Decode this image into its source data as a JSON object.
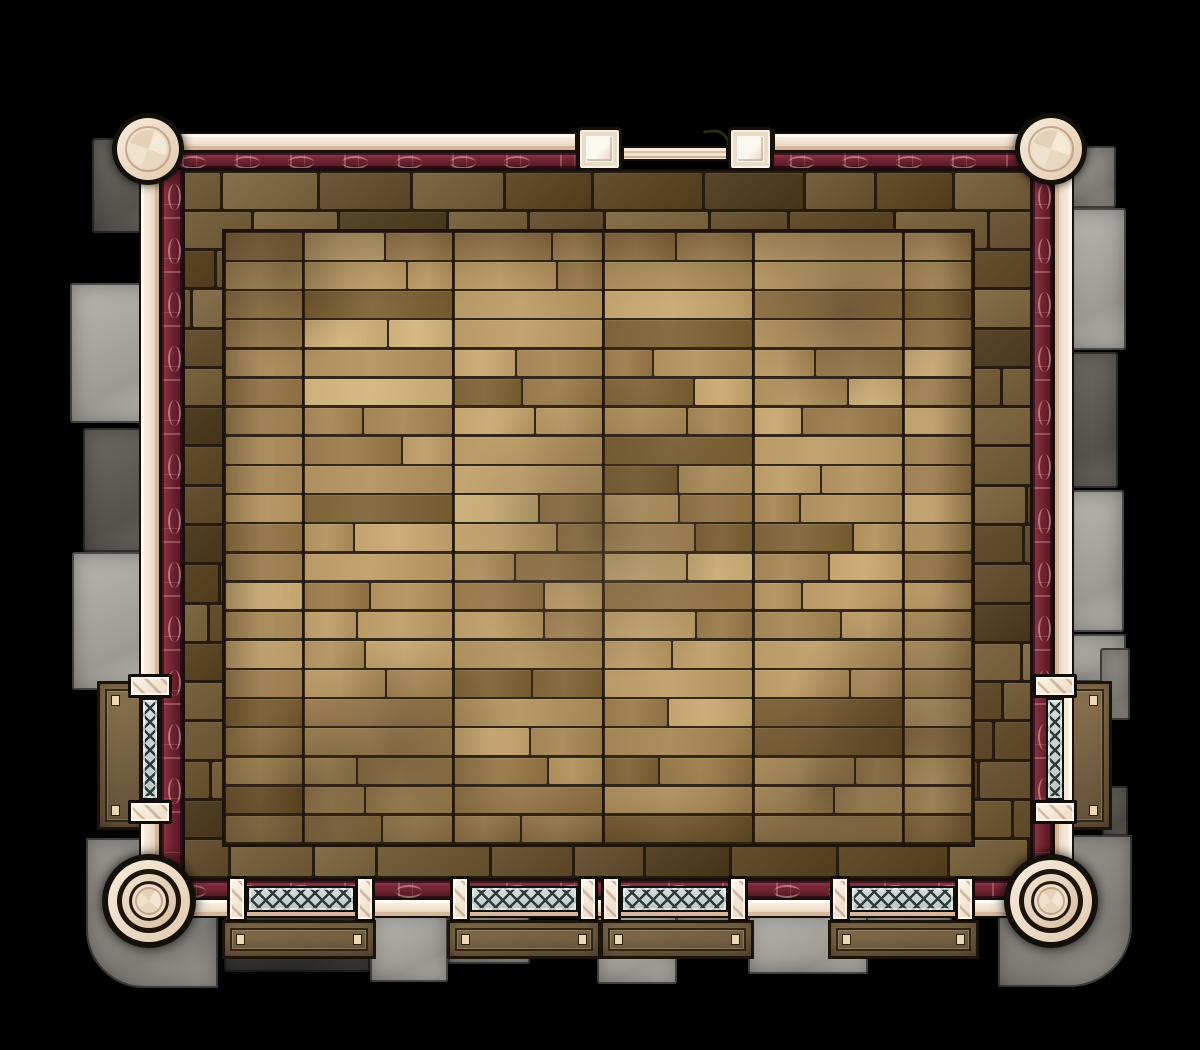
{
  "scene": {
    "kind": "battle-map",
    "label": "stone-hall-with-wood-floor-and-balconies",
    "canvas": {
      "w": 1200,
      "h": 1050,
      "bg": "#000000"
    }
  },
  "palette": {
    "stone": {
      "l": [
        "#b8b6b0",
        "#9d9a94"
      ],
      "m": [
        "#9b9892",
        "#807d77"
      ],
      "d": [
        "#6d6a64",
        "#55524d"
      ],
      "k": [
        "#403e3b",
        "#2f2e2c"
      ]
    },
    "brick": [
      "#6d5839",
      "#76613f",
      "#64502f",
      "#7d6845",
      "#59472b",
      "#85704b"
    ],
    "brick_gap": "#251b10",
    "wood_base": [
      "#c3a46f",
      "#b99a66",
      "#ae905e",
      "#a28455",
      "#97794b"
    ],
    "wood_dark": "#7e6338",
    "wood_light": "#ccb07a",
    "wood_gap": "#33261a",
    "wall_cream_hi": "#fbf4e8",
    "wall_cream_lo": "#e2c9af",
    "outline": "#17100a",
    "trim_red_hi": "#93394a",
    "trim_red_lo": "#521624",
    "trim_motif": "rgba(242,198,188,0.5)",
    "lattice_bg_hi": "#d6dedb",
    "lattice_bg_lo": "#bcc7c4",
    "lattice_line": "#2c3a3c",
    "platform_hi": "#8a7350",
    "platform_lo": "#63513a",
    "peg": "#ead8b6",
    "pillar_cream_hi": "#f7ecdb",
    "pillar_cream_lo": "#e2cab0"
  },
  "stones": [
    [
      92,
      138,
      66,
      95,
      "d",
      null
    ],
    [
      70,
      283,
      90,
      140,
      "l",
      null
    ],
    [
      83,
      428,
      76,
      124,
      "d",
      null
    ],
    [
      72,
      552,
      88,
      138,
      "l",
      null
    ],
    [
      86,
      838,
      132,
      150,
      "m",
      "0 0 0 58px"
    ],
    [
      1066,
      146,
      50,
      62,
      "m",
      null
    ],
    [
      1064,
      208,
      62,
      142,
      "l",
      null
    ],
    [
      1066,
      352,
      52,
      136,
      "d",
      null
    ],
    [
      1064,
      490,
      60,
      142,
      "l",
      null
    ],
    [
      1062,
      634,
      64,
      48,
      "l",
      null
    ],
    [
      1100,
      648,
      30,
      72,
      "m",
      null
    ],
    [
      1102,
      786,
      26,
      50,
      "d",
      null
    ],
    [
      998,
      835,
      134,
      152,
      "m",
      "0 0 62px 0"
    ],
    [
      224,
      912,
      146,
      60,
      "k",
      null
    ],
    [
      370,
      912,
      78,
      70,
      "l",
      null
    ],
    [
      448,
      912,
      82,
      52,
      "m",
      null
    ],
    [
      597,
      912,
      80,
      72,
      "l",
      null
    ],
    [
      676,
      912,
      74,
      46,
      "m",
      null
    ],
    [
      748,
      912,
      120,
      62,
      "l",
      null
    ],
    [
      866,
      912,
      86,
      42,
      "m",
      null
    ]
  ],
  "platforms": [
    [
      222,
      920,
      148,
      33,
      "b"
    ],
    [
      447,
      920,
      148,
      33,
      "b"
    ],
    [
      600,
      920,
      148,
      33,
      "b"
    ],
    [
      828,
      920,
      145,
      33,
      "b"
    ],
    [
      97,
      681,
      50,
      143,
      "l"
    ],
    [
      1058,
      681,
      48,
      143,
      "r"
    ]
  ],
  "floor": {
    "brick": [
      183,
      169,
      849,
      711
    ],
    "wood": [
      222,
      229,
      753,
      618
    ],
    "segments": [
      78,
      228,
      378,
      528,
      678
    ],
    "stains": [
      [
        60,
        40,
        260
      ],
      [
        620,
        80,
        300
      ],
      [
        170,
        520,
        320
      ],
      [
        690,
        490,
        360
      ],
      [
        380,
        300,
        420
      ],
      [
        80,
        560,
        240
      ],
      [
        600,
        560,
        300
      ]
    ],
    "light_patch": [
      380,
      330,
      380
    ]
  },
  "walls": {
    "cream": [
      [
        147,
        132,
        430,
        20,
        "h"
      ],
      [
        773,
        132,
        281,
        20,
        "h"
      ],
      [
        139,
        147,
        22,
        760,
        "v"
      ],
      [
        1053,
        147,
        21,
        760,
        "vr"
      ],
      [
        147,
        898,
        907,
        20,
        "h"
      ]
    ],
    "red": [
      [
        165,
        152,
        412,
        17,
        "h"
      ],
      [
        773,
        152,
        259,
        17,
        "h"
      ],
      [
        161,
        169,
        22,
        715,
        "v"
      ],
      [
        1032,
        169,
        21,
        715,
        "v"
      ],
      [
        165,
        880,
        867,
        19,
        "h"
      ]
    ]
  },
  "door": {
    "posts": [
      [
        577,
        127
      ],
      [
        728,
        127
      ]
    ],
    "post_size": [
      45,
      44
    ],
    "bar": [
      622,
      146,
      106,
      15
    ],
    "curl": [
      704,
      129,
      22,
      15
    ]
  },
  "rails": {
    "posts": [
      [
        227,
        876,
        20,
        46
      ],
      [
        355,
        876,
        20,
        46
      ],
      [
        450,
        876,
        20,
        46
      ],
      [
        578,
        876,
        20,
        46
      ],
      [
        601,
        876,
        20,
        46
      ],
      [
        728,
        876,
        20,
        46
      ],
      [
        830,
        876,
        20,
        46
      ],
      [
        955,
        876,
        20,
        46
      ],
      [
        128,
        674,
        44,
        24
      ],
      [
        128,
        800,
        44,
        24
      ],
      [
        1033,
        674,
        44,
        24
      ],
      [
        1033,
        800,
        44,
        24
      ]
    ],
    "lattices": [
      [
        247,
        886,
        108,
        26
      ],
      [
        470,
        886,
        108,
        26
      ],
      [
        621,
        886,
        107,
        26
      ],
      [
        850,
        886,
        105,
        26
      ],
      [
        141,
        698,
        18,
        102
      ],
      [
        1046,
        698,
        18,
        102
      ]
    ]
  },
  "pillars": {
    "small": [
      [
        148,
        149
      ],
      [
        1051,
        149
      ]
    ],
    "large": [
      [
        149,
        901
      ],
      [
        1051,
        901
      ]
    ]
  }
}
